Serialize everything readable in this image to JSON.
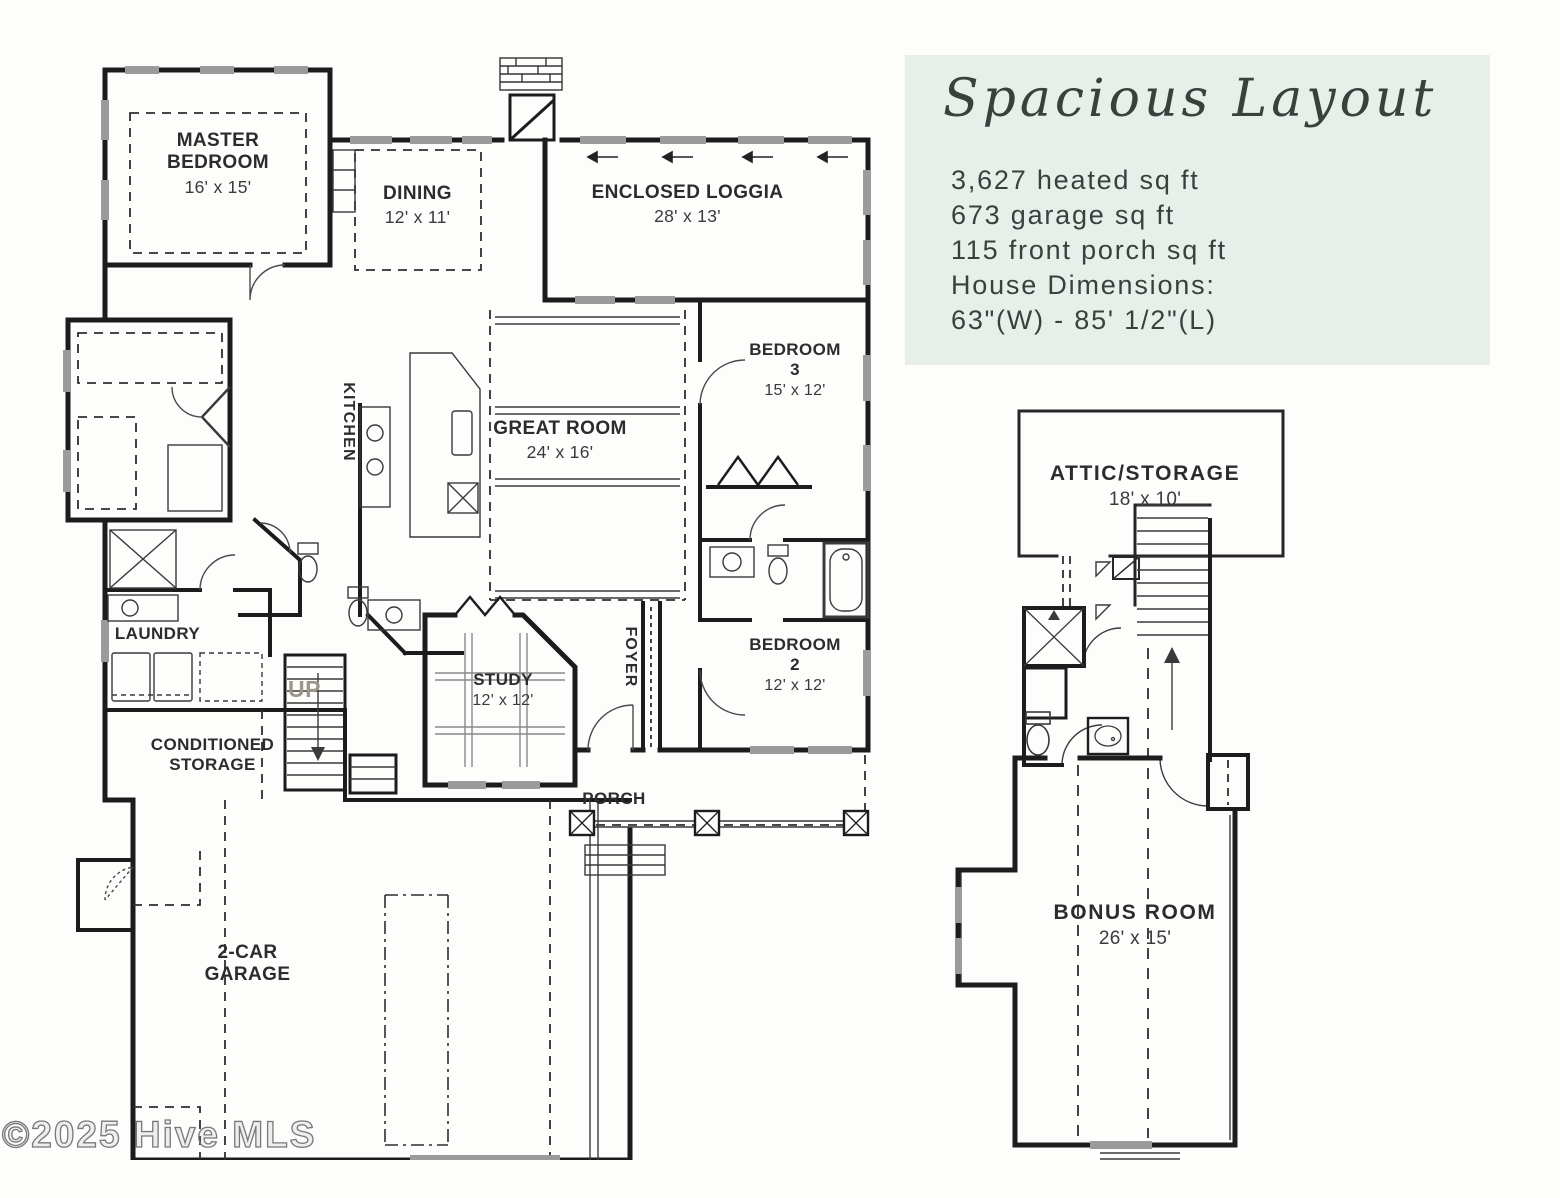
{
  "info_panel": {
    "title": "Spacious Layout",
    "line1": "3,627 heated sq ft",
    "line2": "673 garage sq ft",
    "line3": "115 front porch sq ft",
    "line4": "House Dimensions:",
    "line5": "63\"(W) - 85' 1/2\"(L)",
    "background_color": "#e8efeb",
    "text_color": "#37423d"
  },
  "plan": {
    "wall_color": "#1c1c1c",
    "window_color": "#9b9b9b",
    "rooms": {
      "master": {
        "name": "MASTER BEDROOM",
        "dims": "16' x 15'"
      },
      "dining": {
        "name": "DINING",
        "dims": "12' x 11'"
      },
      "loggia": {
        "name": "ENCLOSED LOGGIA",
        "dims": "28' x 13'"
      },
      "kitchen": {
        "name": "KITCHEN"
      },
      "great": {
        "name": "GREAT ROOM",
        "dims": "24' x 16'"
      },
      "bed3": {
        "name": "BEDROOM 3",
        "dims": "15' x 12'"
      },
      "bed2": {
        "name": "BEDROOM 2",
        "dims": "12' x 12'"
      },
      "laundry": {
        "name": "LAUNDRY"
      },
      "storage": {
        "name": "CONDITIONED STORAGE"
      },
      "study": {
        "name": "STUDY",
        "dims": "12' x 12'"
      },
      "foyer": {
        "name": "FOYER"
      },
      "porch": {
        "name": "PORCH"
      },
      "up": {
        "name": "UP"
      },
      "garage": {
        "name": "2-CAR GARAGE"
      }
    }
  },
  "upper": {
    "attic": {
      "name": "ATTIC/STORAGE",
      "dims": "18' x 10'"
    },
    "bonus": {
      "name": "BONUS ROOM",
      "dims": "26' x 15'"
    }
  },
  "watermark": {
    "text": "©2025 Hive MLS"
  }
}
